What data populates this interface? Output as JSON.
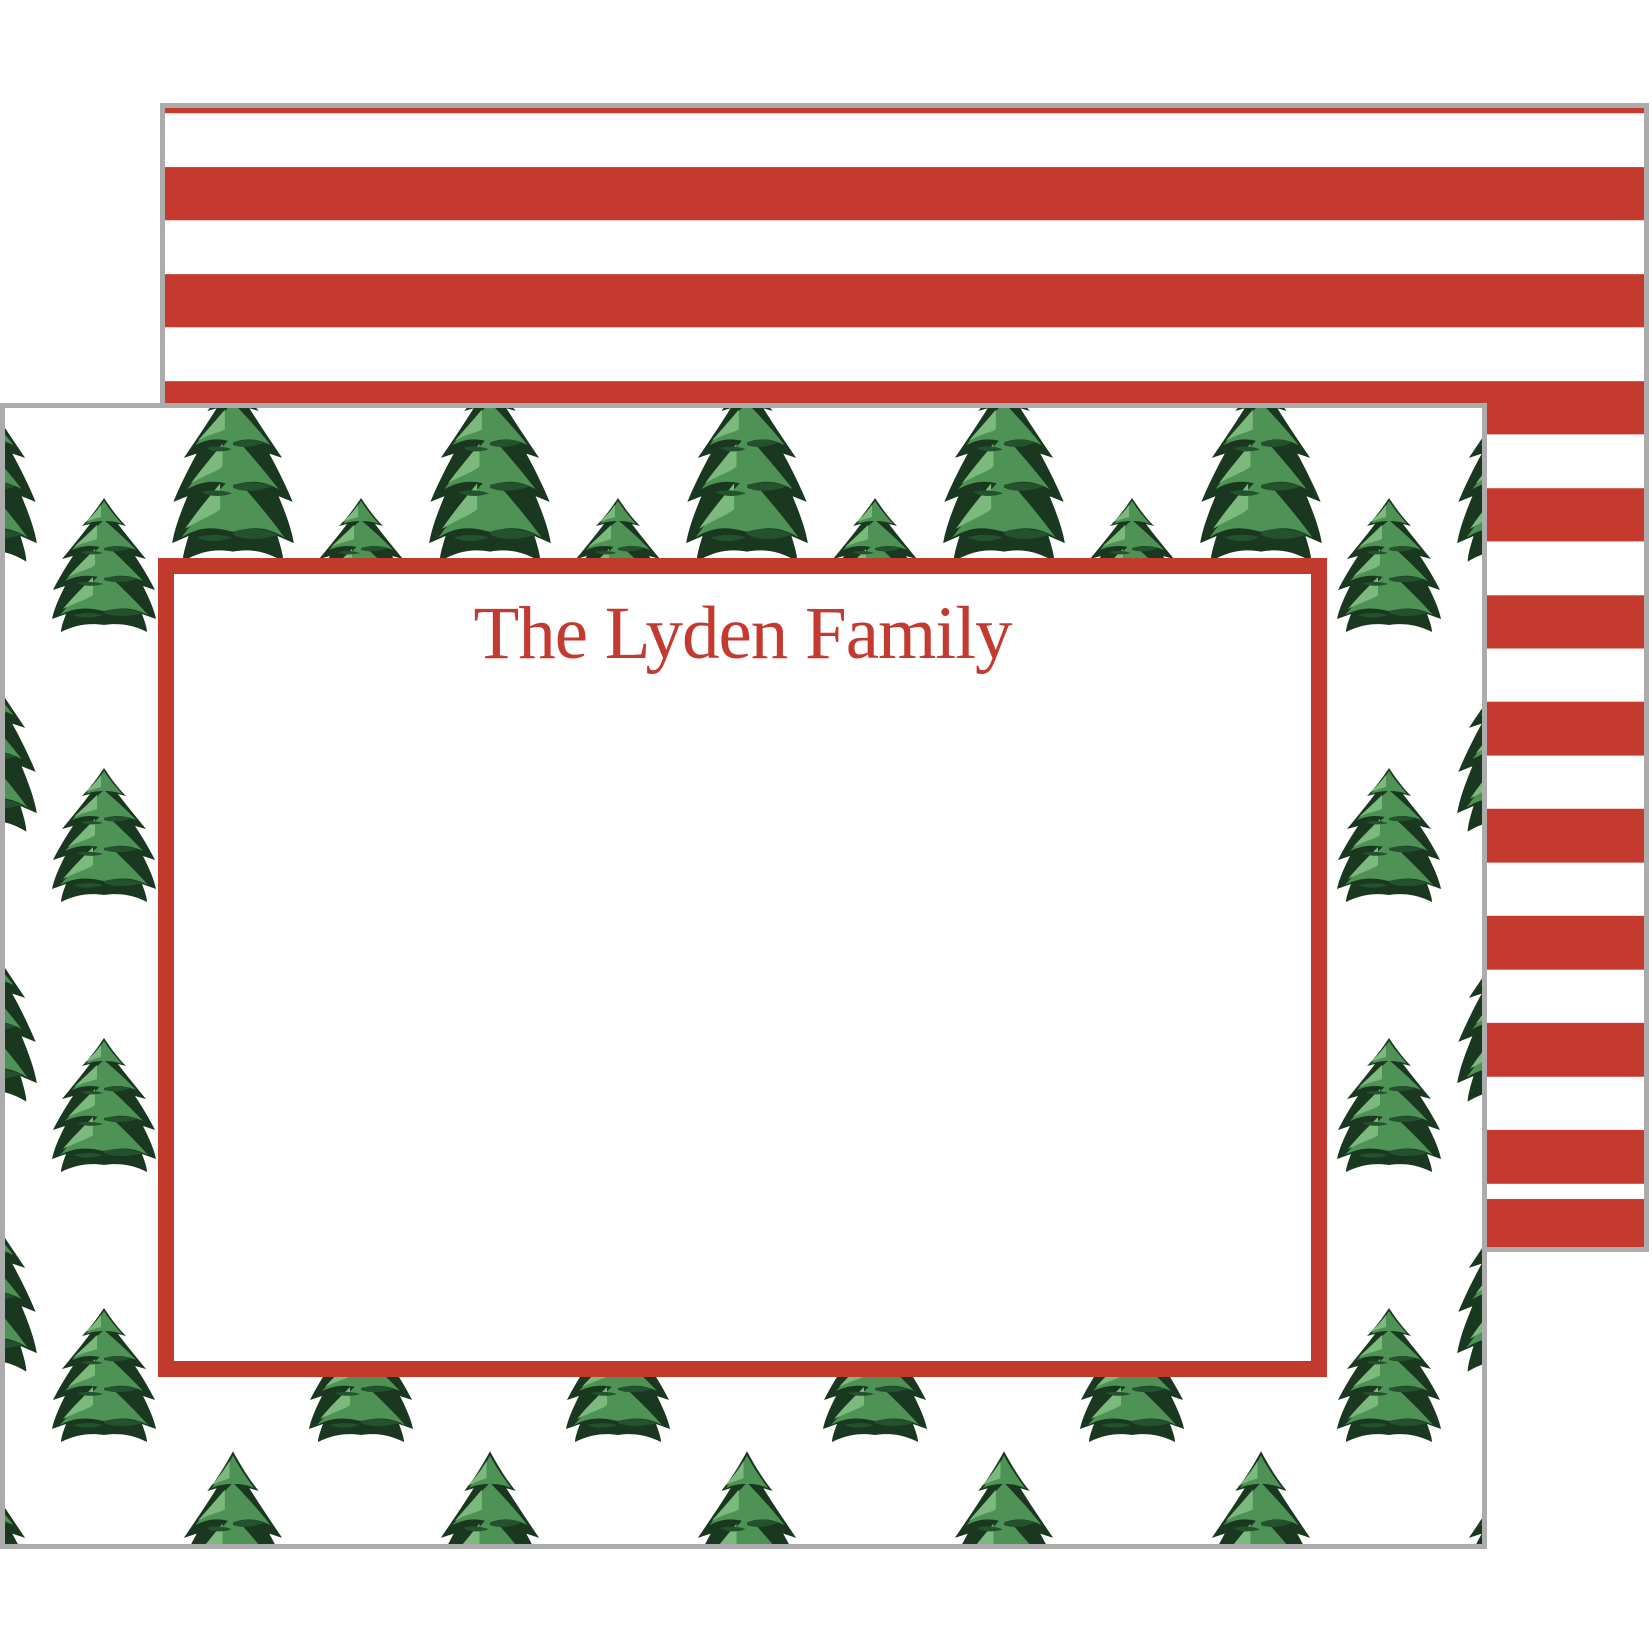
{
  "page": {
    "background": "#ffffff"
  },
  "front_card": {
    "name_text": "The Lyden Family",
    "pattern_icon": "christmas-tree-icon",
    "colors": {
      "frame-red": "#c2392e",
      "name-red": "#c23a30",
      "edge-gray": "#acacac",
      "tree-mid": "#4e9355",
      "tree-light": "#7cb97c",
      "tree-dark": "#24512e",
      "tree-darkest": "#19381f"
    }
  },
  "back_card": {
    "pattern": "horizontal-stripes",
    "colors": {
      "stripe-red": "#c5392e",
      "stripe-white": "#ffffff"
    }
  }
}
